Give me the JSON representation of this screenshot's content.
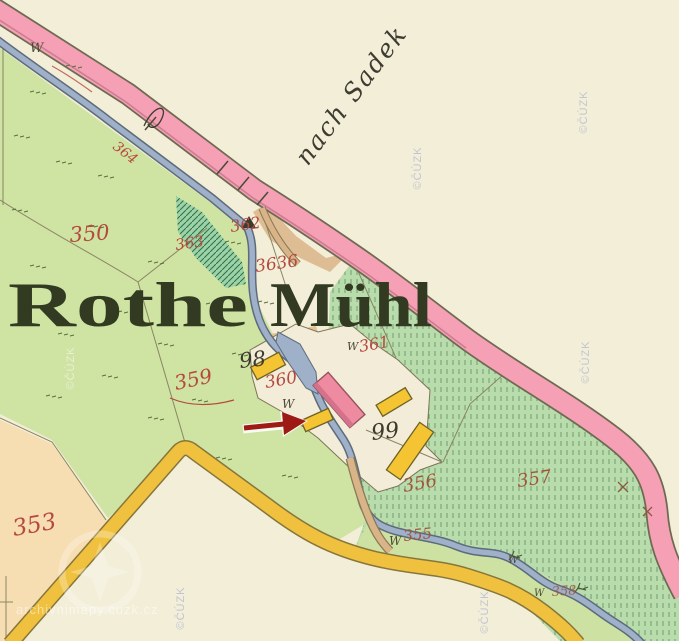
{
  "map": {
    "title": "Rothe Mühl",
    "title_part1": "Rothe",
    "title_part2": "Mühl",
    "direction_label": "nach Sadek",
    "parcel_labels": {
      "p350": "350",
      "p353": "353",
      "p355": "355",
      "p356": "356",
      "p357": "357",
      "p358": "358",
      "p359": "359",
      "p360": "360",
      "p361": "361",
      "p362": "362",
      "p363": "363",
      "p3636": "3636",
      "p364": "364"
    },
    "building_labels": {
      "b98": "98",
      "b99": "99"
    },
    "symbols": {
      "meadow": "W"
    },
    "colors": {
      "paper": "#f3eed7",
      "field_green": "#cfe3a3",
      "hatch_green": "#b8dcab",
      "orchard_green": "#9cd2a8",
      "road_pink": "#f5a0b4",
      "road_yellow": "#f0c13e",
      "stream_blue": "#9fb0c9",
      "building_yellow": "#f4c433",
      "building_pink": "#ef8ba1",
      "peach_field": "#f6ddb2",
      "label_red": "#b5493e",
      "label_black": "#3c3a2b"
    }
  },
  "annotation": {
    "shape": "arrow-right",
    "color": "#9e1a15"
  },
  "watermarks": {
    "copyright": "©ČÚZK",
    "site": "archivnimapy.cuzk.cz"
  }
}
